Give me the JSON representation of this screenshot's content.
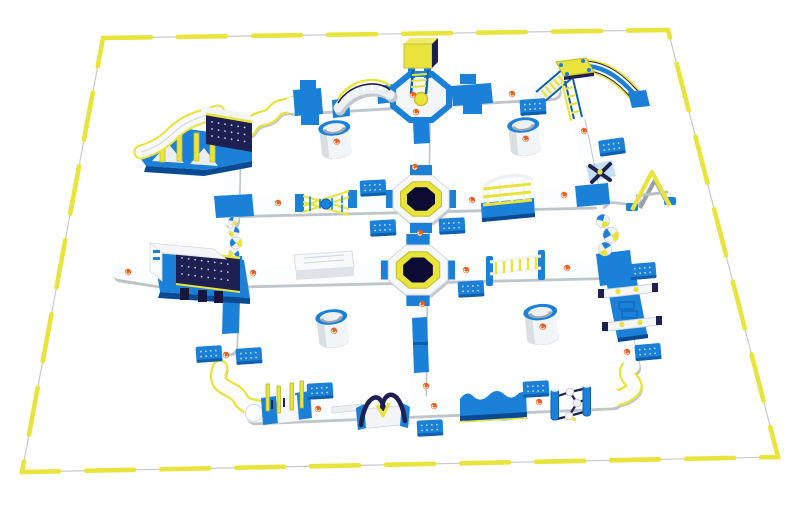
{
  "scene": {
    "label": "Aerial 3D render of a giant inflatable floating water park: white and blue walkway grid with slides, trampolines, barrels and climbing obstacles inside a yellow-buoy perimeter on open white water",
    "type": "product-render",
    "background": "#ffffff"
  },
  "palette": {
    "blue": "#1a80d8",
    "blue-d": "#0e5fae",
    "blue-deep": "#0a4a92",
    "yellow": "#e9e43c",
    "yellow-d": "#b9b324",
    "navy": "#1d2050",
    "navy-deep": "#0b0b34",
    "orange": "#e8611f",
    "white": "#ffffff",
    "shade": "#c2c9ce",
    "boundary-line": "#c7cacc"
  },
  "boundary": {
    "shape": "perspective-quadrilateral",
    "corners": [
      [
        103,
        38
      ],
      [
        668,
        30
      ],
      [
        778,
        457
      ],
      [
        22,
        472
      ]
    ],
    "marker_style": "yellow float buoy dashes over thin boom line"
  },
  "inventory": {
    "trampolines": 2,
    "slide_towers": 3,
    "barrel_rollers": 4,
    "dock_pads": 13,
    "stepping_stones_left": 5,
    "stepping_stones_right": 3,
    "s_curve_paths": 3,
    "brand_marks": 20
  },
  "features": [
    {
      "id": "pool-boundary",
      "label": "Perimeter boom line"
    },
    {
      "id": "perimeter-buoys",
      "label": "Yellow float buoys on perimeter"
    },
    {
      "id": "walkway-grid",
      "label": "Floating walkway grid"
    },
    {
      "id": "s-curve-path-top",
      "label": "S-curve connector path north-west"
    },
    {
      "id": "s-curve-path-bottom-left",
      "label": "S-curve connector path south-west"
    },
    {
      "id": "s-curve-path-bottom-right",
      "label": "S-curve connector path south-east"
    },
    {
      "id": "wave-slide-tower",
      "label": "Wave slide with studded climbing wall north-west"
    },
    {
      "id": "summit-tower",
      "label": "Summit tower with ladder north-center"
    },
    {
      "id": "arch-bridge",
      "label": "Arched rail bridge"
    },
    {
      "id": "peak-slide-tower",
      "label": "Peak slide tower with climb ramp north-east"
    },
    {
      "id": "jump-trampoline-1",
      "label": "Octagonal jump trampoline north"
    },
    {
      "id": "jump-trampoline-2",
      "label": "Octagonal jump trampoline south"
    },
    {
      "id": "twist-ladders",
      "label": "Crossed twist ladders"
    },
    {
      "id": "cage-crawl",
      "label": "Caged crawl tunnel"
    },
    {
      "id": "x-balance-beam",
      "label": "X balance element"
    },
    {
      "id": "a-frame-climb",
      "label": "A-frame tube climb"
    },
    {
      "id": "stepping-stones-right",
      "label": "Stepping stone floats east"
    },
    {
      "id": "hurdle-beams",
      "label": "Hurdle balance beams"
    },
    {
      "id": "stepping-stones-left",
      "label": "Stepping stone floats west"
    },
    {
      "id": "climb-box-platform",
      "label": "Climbing box platform west"
    },
    {
      "id": "deck-platform",
      "label": "Flat deck platform"
    },
    {
      "id": "ladder-bridge",
      "label": "Horizontal ladder bridge"
    },
    {
      "id": "barrel-roller-1",
      "label": "Barrel roller north-west"
    },
    {
      "id": "barrel-roller-2",
      "label": "Barrel roller north-east"
    },
    {
      "id": "barrel-roller-3",
      "label": "Barrel roller south-west"
    },
    {
      "id": "barrel-roller-4",
      "label": "Barrel roller south-east"
    },
    {
      "id": "flip-bar-gates",
      "label": "Flip-bar gate posts"
    },
    {
      "id": "link-beam",
      "label": "Narrow link beam"
    },
    {
      "id": "x-arch-climb",
      "label": "X-arch climb"
    },
    {
      "id": "wave-moguls",
      "label": "Wave mogul bumps"
    },
    {
      "id": "roller-wheel",
      "label": "Roller wheel obstacle"
    },
    {
      "id": "dock-pads",
      "label": "Blue docking pads"
    },
    {
      "id": "brand-logos",
      "label": "Orange brand marks"
    }
  ]
}
